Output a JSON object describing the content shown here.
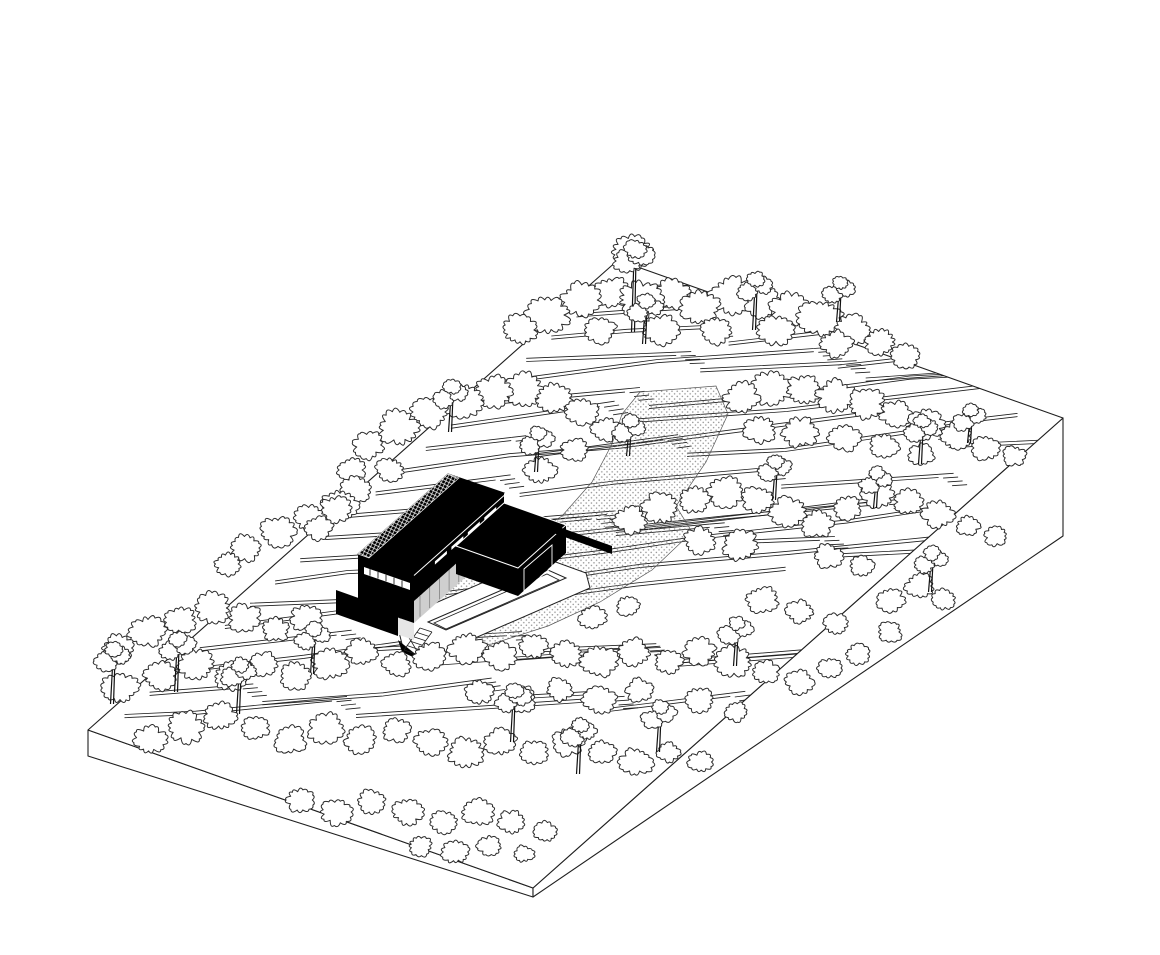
{
  "diagram": {
    "viewbox": "0 0 1160 955",
    "colors": {
      "paper": "#ffffff",
      "line": "#1f1f1f",
      "tree_line": "#2b2b2b",
      "building": "#000000",
      "glass": "#cfcfcf",
      "glass_light": "#e6e6e6",
      "stipple": "#8f8f8f",
      "hairline": "#ffffff"
    },
    "site": {
      "top_face": [
        [
          88,
          730
        ],
        [
          618,
          260
        ],
        [
          1063,
          418
        ],
        [
          533,
          888
        ]
      ],
      "left_face": [
        [
          88,
          730
        ],
        [
          533,
          888
        ],
        [
          533,
          897
        ],
        [
          88,
          756
        ]
      ],
      "right_face": [
        [
          533,
          888
        ],
        [
          1063,
          418
        ],
        [
          1063,
          536
        ],
        [
          533,
          897
        ]
      ]
    },
    "terraces": {
      "rows": 20,
      "seed": 7
    },
    "path": {
      "polygon": [
        [
          640,
          392
        ],
        [
          716,
          386
        ],
        [
          728,
          414
        ],
        [
          706,
          462
        ],
        [
          676,
          506
        ],
        [
          692,
          532
        ],
        [
          652,
          570
        ],
        [
          600,
          602
        ],
        [
          548,
          626
        ],
        [
          492,
          644
        ],
        [
          440,
          650
        ],
        [
          404,
          632
        ],
        [
          398,
          606
        ],
        [
          372,
          596
        ],
        [
          368,
          576
        ],
        [
          416,
          560
        ],
        [
          470,
          556
        ],
        [
          524,
          540
        ],
        [
          562,
          516
        ],
        [
          592,
          482
        ],
        [
          612,
          444
        ],
        [
          622,
          414
        ]
      ]
    },
    "building": {
      "bar_roof": [
        [
          358,
          554
        ],
        [
          448,
          474
        ],
        [
          504,
          493
        ],
        [
          414,
          573
        ]
      ],
      "skylight": [
        [
          358,
          554
        ],
        [
          448,
          474
        ],
        [
          459,
          478
        ],
        [
          369,
          558
        ]
      ],
      "bar_front": [
        [
          414,
          573
        ],
        [
          504,
          493
        ],
        [
          504,
          521
        ],
        [
          414,
          601
        ]
      ],
      "bar_sw": [
        [
          358,
          554
        ],
        [
          414,
          573
        ],
        [
          414,
          623
        ],
        [
          358,
          604
        ]
      ],
      "glass_band": [
        [
          414,
          601
        ],
        [
          504,
          521
        ],
        [
          504,
          543
        ],
        [
          414,
          623
        ]
      ],
      "sw_band": [
        [
          358,
          604
        ],
        [
          414,
          623
        ],
        [
          414,
          640
        ],
        [
          358,
          621
        ]
      ],
      "wing_roof": [
        [
          456,
          546
        ],
        [
          504,
          503
        ],
        [
          566,
          525
        ],
        [
          518,
          568
        ]
      ],
      "wing_front": [
        [
          518,
          568
        ],
        [
          566,
          525
        ],
        [
          566,
          553
        ],
        [
          518,
          596
        ]
      ],
      "wing_sw": [
        [
          456,
          546
        ],
        [
          518,
          568
        ],
        [
          518,
          596
        ],
        [
          456,
          574
        ]
      ],
      "wing_opening": [
        [
          524,
          569
        ],
        [
          552,
          545
        ],
        [
          552,
          567
        ],
        [
          524,
          591
        ]
      ],
      "wall_right": [
        [
          545,
          522
        ],
        [
          612,
          546
        ],
        [
          612,
          554
        ],
        [
          545,
          530
        ]
      ],
      "wall_left": [
        [
          336,
          590
        ],
        [
          398,
          612
        ],
        [
          398,
          636
        ],
        [
          336,
          614
        ]
      ],
      "louver_band": [
        [
          364,
          567
        ],
        [
          410,
          583
        ],
        [
          410,
          590
        ],
        [
          364,
          574
        ]
      ],
      "slit_offsets": [
        28,
        50,
        72,
        94
      ],
      "roof_hairline": [
        [
          414,
          575.5
        ],
        [
          504,
          495.5
        ]
      ]
    },
    "deck": {
      "outline": [
        [
          396,
          620
        ],
        [
          542,
          557
        ],
        [
          586,
          573
        ],
        [
          590,
          588
        ],
        [
          452,
          648
        ],
        [
          430,
          666
        ],
        [
          402,
          644
        ]
      ],
      "pool_outer": [
        [
          428,
          622
        ],
        [
          548,
          570
        ],
        [
          566,
          578
        ],
        [
          446,
          630
        ]
      ],
      "pool_inner": [
        [
          434,
          623
        ],
        [
          547,
          574
        ],
        [
          559,
          580
        ],
        [
          446,
          629
        ]
      ],
      "apron": [
        [
          402,
          626
        ],
        [
          426,
          666
        ],
        [
          578,
          655
        ]
      ],
      "shadow": [
        [
          398,
          640
        ],
        [
          424,
          662
        ],
        [
          402,
          652
        ]
      ],
      "stair": {
        "a1": [
          420,
          628
        ],
        "a2": [
          404,
          650
        ],
        "b1": [
          432,
          632
        ],
        "b2": [
          416,
          654
        ],
        "treads": 6
      }
    },
    "trees": {
      "seed": 11,
      "front_threshold": 560,
      "canopies": [
        [
          633,
          252,
          20
        ],
        [
          520,
          330,
          18
        ],
        [
          548,
          315,
          22
        ],
        [
          580,
          300,
          20
        ],
        [
          612,
          292,
          18
        ],
        [
          640,
          300,
          22
        ],
        [
          672,
          295,
          18
        ],
        [
          700,
          308,
          20
        ],
        [
          732,
          296,
          22
        ],
        [
          762,
          302,
          18
        ],
        [
          790,
          310,
          20
        ],
        [
          820,
          318,
          22
        ],
        [
          852,
          330,
          18
        ],
        [
          880,
          342,
          16
        ],
        [
          600,
          330,
          16
        ],
        [
          660,
          330,
          18
        ],
        [
          716,
          330,
          16
        ],
        [
          776,
          330,
          18
        ],
        [
          836,
          344,
          16
        ],
        [
          906,
          356,
          14
        ],
        [
          352,
          470,
          14
        ],
        [
          368,
          445,
          16
        ],
        [
          398,
          428,
          20
        ],
        [
          430,
          412,
          18
        ],
        [
          462,
          400,
          20
        ],
        [
          494,
          392,
          18
        ],
        [
          524,
          390,
          20
        ],
        [
          554,
          398,
          18
        ],
        [
          582,
          412,
          16
        ],
        [
          606,
          430,
          14
        ],
        [
          356,
          490,
          16
        ],
        [
          390,
          470,
          14
        ],
        [
          540,
          470,
          16
        ],
        [
          575,
          450,
          14
        ],
        [
          336,
          510,
          16
        ],
        [
          318,
          528,
          14
        ],
        [
          742,
          398,
          18
        ],
        [
          772,
          388,
          20
        ],
        [
          804,
          390,
          18
        ],
        [
          836,
          396,
          20
        ],
        [
          866,
          404,
          18
        ],
        [
          896,
          414,
          16
        ],
        [
          926,
          424,
          18
        ],
        [
          956,
          436,
          16
        ],
        [
          986,
          448,
          14
        ],
        [
          1014,
          456,
          12
        ],
        [
          760,
          430,
          16
        ],
        [
          800,
          432,
          18
        ],
        [
          844,
          438,
          16
        ],
        [
          884,
          446,
          14
        ],
        [
          922,
          455,
          13
        ],
        [
          228,
          564,
          14
        ],
        [
          246,
          548,
          16
        ],
        [
          278,
          532,
          18
        ],
        [
          310,
          518,
          16
        ],
        [
          340,
          505,
          18
        ],
        [
          630,
          520,
          16
        ],
        [
          660,
          508,
          18
        ],
        [
          694,
          500,
          16
        ],
        [
          726,
          492,
          18
        ],
        [
          758,
          500,
          16
        ],
        [
          788,
          512,
          18
        ],
        [
          818,
          524,
          16
        ],
        [
          848,
          508,
          14
        ],
        [
          878,
          494,
          16
        ],
        [
          908,
          502,
          14
        ],
        [
          938,
          514,
          16
        ],
        [
          968,
          526,
          12
        ],
        [
          996,
          536,
          12
        ],
        [
          700,
          540,
          16
        ],
        [
          740,
          545,
          18
        ],
        [
          828,
          556,
          14
        ],
        [
          862,
          566,
          12
        ],
        [
          118,
          648,
          16
        ],
        [
          148,
          632,
          18
        ],
        [
          180,
          620,
          16
        ],
        [
          212,
          608,
          18
        ],
        [
          244,
          618,
          16
        ],
        [
          276,
          630,
          14
        ],
        [
          306,
          618,
          16
        ],
        [
          120,
          688,
          18
        ],
        [
          160,
          676,
          16
        ],
        [
          196,
          664,
          18
        ],
        [
          230,
          676,
          16
        ],
        [
          264,
          664,
          14
        ],
        [
          296,
          676,
          16
        ],
        [
          330,
          664,
          18
        ],
        [
          362,
          652,
          16
        ],
        [
          396,
          664,
          14
        ],
        [
          430,
          656,
          16
        ],
        [
          466,
          648,
          18
        ],
        [
          500,
          656,
          16
        ],
        [
          534,
          646,
          14
        ],
        [
          566,
          654,
          16
        ],
        [
          600,
          662,
          18
        ],
        [
          634,
          652,
          16
        ],
        [
          668,
          662,
          14
        ],
        [
          700,
          652,
          16
        ],
        [
          734,
          662,
          18
        ],
        [
          766,
          672,
          14
        ],
        [
          800,
          682,
          14
        ],
        [
          830,
          668,
          12
        ],
        [
          858,
          654,
          12
        ],
        [
          890,
          600,
          14
        ],
        [
          920,
          586,
          14
        ],
        [
          944,
          600,
          12
        ],
        [
          762,
          600,
          16
        ],
        [
          800,
          612,
          14
        ],
        [
          836,
          624,
          12
        ],
        [
          592,
          618,
          14
        ],
        [
          628,
          606,
          12
        ],
        [
          600,
          700,
          16
        ],
        [
          560,
          690,
          14
        ],
        [
          520,
          700,
          16
        ],
        [
          480,
          692,
          14
        ],
        [
          640,
          690,
          14
        ],
        [
          700,
          700,
          14
        ],
        [
          736,
          712,
          12
        ],
        [
          890,
          632,
          12
        ],
        [
          150,
          740,
          16
        ],
        [
          186,
          728,
          18
        ],
        [
          220,
          716,
          16
        ],
        [
          256,
          728,
          14
        ],
        [
          290,
          740,
          16
        ],
        [
          326,
          728,
          18
        ],
        [
          360,
          740,
          16
        ],
        [
          396,
          730,
          14
        ],
        [
          430,
          742,
          16
        ],
        [
          466,
          752,
          18
        ],
        [
          500,
          742,
          16
        ],
        [
          534,
          752,
          14
        ],
        [
          568,
          742,
          16
        ],
        [
          602,
          752,
          14
        ],
        [
          636,
          762,
          16
        ],
        [
          668,
          752,
          12
        ],
        [
          700,
          762,
          12
        ],
        [
          300,
          800,
          14
        ],
        [
          336,
          812,
          16
        ],
        [
          372,
          802,
          14
        ],
        [
          408,
          812,
          16
        ],
        [
          444,
          822,
          14
        ],
        [
          478,
          812,
          16
        ],
        [
          512,
          822,
          14
        ],
        [
          546,
          832,
          12
        ],
        [
          420,
          846,
          12
        ],
        [
          456,
          852,
          14
        ],
        [
          490,
          846,
          12
        ],
        [
          524,
          854,
          10
        ]
      ],
      "pines": [
        [
          633,
          332,
          74
        ],
        [
          754,
          330,
          42
        ],
        [
          644,
          344,
          34
        ],
        [
          838,
          322,
          30
        ],
        [
          450,
          432,
          36
        ],
        [
          536,
          472,
          30
        ],
        [
          920,
          464,
          34
        ],
        [
          774,
          500,
          30
        ],
        [
          628,
          456,
          26
        ],
        [
          875,
          508,
          26
        ],
        [
          969,
          443,
          24
        ],
        [
          112,
          704,
          46
        ],
        [
          176,
          692,
          44
        ],
        [
          238,
          714,
          40
        ],
        [
          312,
          674,
          36
        ],
        [
          512,
          742,
          42
        ],
        [
          578,
          774,
          40
        ],
        [
          658,
          752,
          36
        ],
        [
          735,
          666,
          34
        ],
        [
          930,
          592,
          30
        ]
      ]
    }
  }
}
